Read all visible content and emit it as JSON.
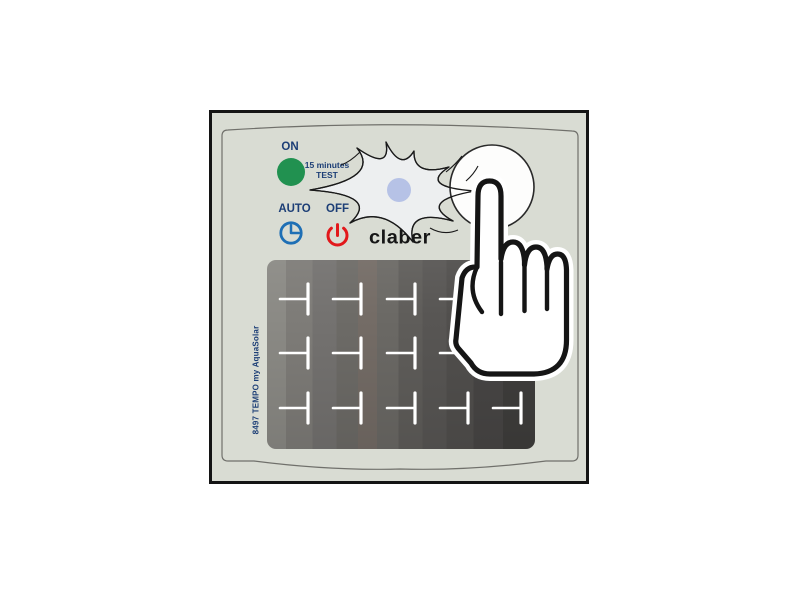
{
  "brand": "claber",
  "labels": {
    "on": "ON",
    "test_line1": "15 minutes",
    "test_line2": "TEST",
    "auto": "AUTO",
    "off": "OFF",
    "model_code": "8497 TEMPO my AquaSolar"
  },
  "icons": {
    "on_indicator": "green-led-circle",
    "auto_mode": "clock-icon",
    "off_mode": "power-icon",
    "test_flash": "starburst-flash",
    "flash_center": "led-dot",
    "test_button": "round-button",
    "press_gesture": "pointing-hand"
  },
  "colors": {
    "label_text": "#1c3e76",
    "on_green": "#219150",
    "auto_blue": "#1e6fb5",
    "off_red": "#e2181b",
    "led_dot": "#b6c2e6",
    "flash_fill": "#edeff0",
    "device_body": "#d9dcd3",
    "device_border": "#141414",
    "panel_dark": "#4a4846",
    "logo_black": "#161616"
  }
}
